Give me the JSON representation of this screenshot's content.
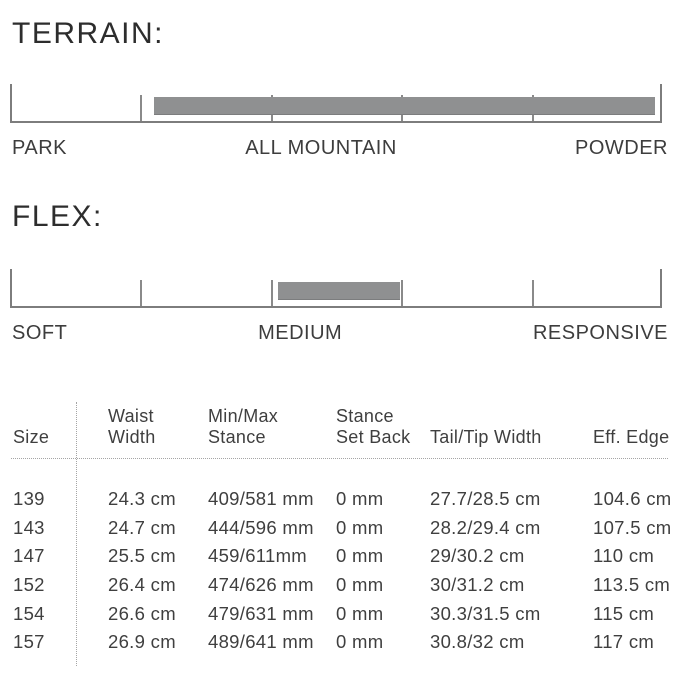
{
  "colors": {
    "background": "#ffffff",
    "text": "#3a3a3a",
    "heading_text": "#2d2d2d",
    "range_bar": "#8f9091",
    "axis_line": "#7d7d7d",
    "dotted_line": "#a5a5a5"
  },
  "chart_data": [
    {
      "type": "bar",
      "id": "terrain",
      "title": "TERRAIN:",
      "tick_labels": [
        "PARK",
        "ALL MOUNTAIN",
        "POWDER"
      ],
      "axis_ticks_pct": [
        0,
        20,
        40,
        60,
        80,
        100
      ],
      "bar_span_pct": [
        22.1,
        98.9
      ],
      "xlim": [
        0,
        100
      ],
      "note": "single horizontal range bar on a 5-segment scale"
    },
    {
      "type": "bar",
      "id": "flex",
      "title": "FLEX:",
      "tick_labels": [
        "SOFT",
        "MEDIUM",
        "RESPONSIVE"
      ],
      "axis_ticks_pct": [
        0,
        20,
        40,
        60,
        80,
        100
      ],
      "bar_span_pct": [
        41.1,
        59.8
      ],
      "xlim": [
        0,
        100
      ],
      "note": "single horizontal range bar on a 5-segment scale"
    },
    {
      "type": "table",
      "id": "size-specs",
      "columns": [
        {
          "line1": "",
          "line2": "Size"
        },
        {
          "line1": "Waist",
          "line2": "Width"
        },
        {
          "line1": "Min/Max",
          "line2": "Stance"
        },
        {
          "line1": "Stance",
          "line2": "Set Back"
        },
        {
          "line1": "",
          "line2": "Tail/Tip Width"
        },
        {
          "line1": "",
          "line2": "Eff. Edge"
        }
      ],
      "rows": [
        {
          "size": "139",
          "waist_width": "24.3 cm",
          "min_max_stance": "409/581 mm",
          "stance_set_back": "0 mm",
          "tail_tip_width": "27.7/28.5 cm",
          "eff_edge": "104.6 cm"
        },
        {
          "size": "143",
          "waist_width": "24.7 cm",
          "min_max_stance": "444/596 mm",
          "stance_set_back": "0 mm",
          "tail_tip_width": "28.2/29.4 cm",
          "eff_edge": "107.5 cm"
        },
        {
          "size": "147",
          "waist_width": "25.5 cm",
          "min_max_stance": "459/611mm",
          "stance_set_back": "0 mm",
          "tail_tip_width": "29/30.2 cm",
          "eff_edge": "110 cm"
        },
        {
          "size": "152",
          "waist_width": "26.4 cm",
          "min_max_stance": "474/626 mm",
          "stance_set_back": "0 mm",
          "tail_tip_width": "30/31.2 cm",
          "eff_edge": "113.5 cm"
        },
        {
          "size": "154",
          "waist_width": "26.6 cm",
          "min_max_stance": "479/631 mm",
          "stance_set_back": "0 mm",
          "tail_tip_width": "30.3/31.5 cm",
          "eff_edge": "115 cm"
        },
        {
          "size": "157",
          "waist_width": "26.9 cm",
          "min_max_stance": "489/641 mm",
          "stance_set_back": "0 mm",
          "tail_tip_width": "30.8/32 cm",
          "eff_edge": "117 cm"
        }
      ]
    }
  ]
}
